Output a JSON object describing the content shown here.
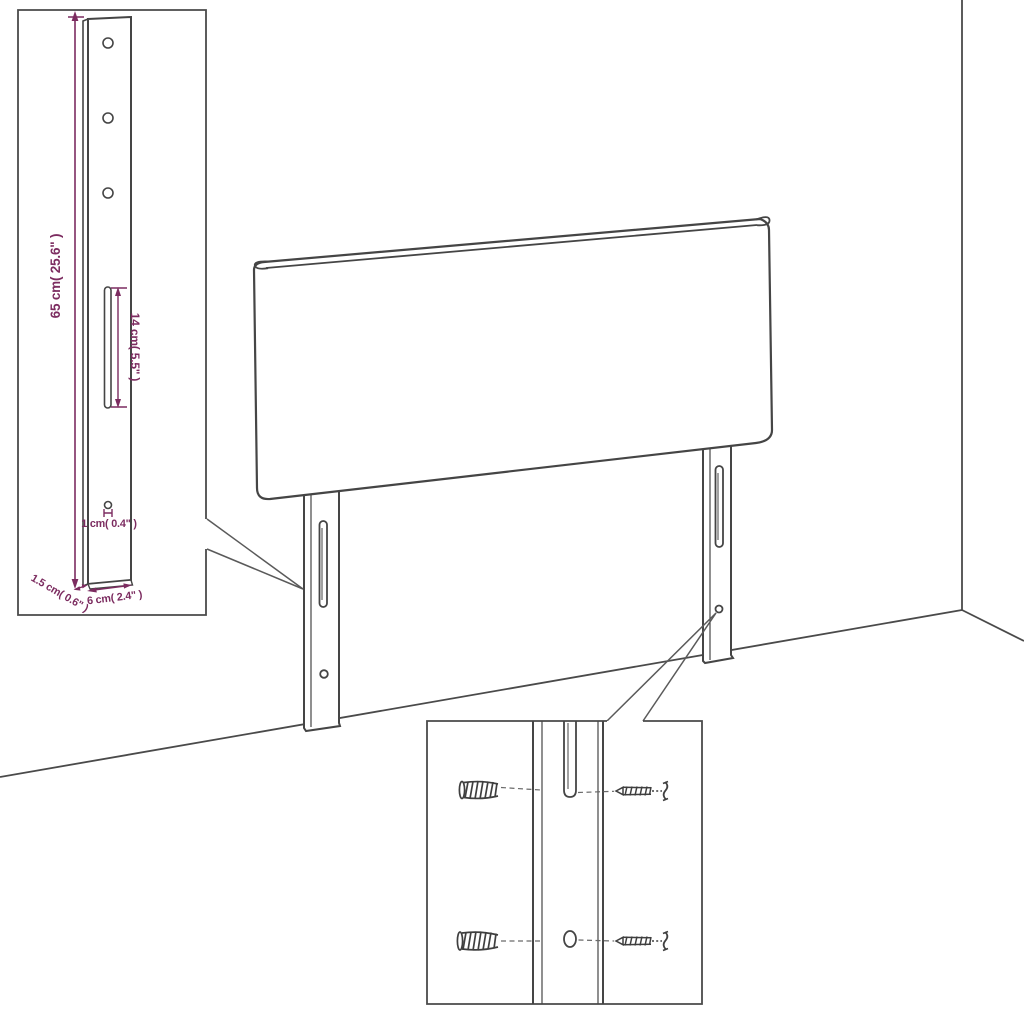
{
  "diagram": {
    "type": "product-dimension-drawing",
    "subject": "upholstered headboard with two adjustable mounting legs",
    "views": {
      "main": "perspective view of headboard standing against wall corner",
      "inset_top_left": "magnified front view of mounting leg with drill holes and slot",
      "inset_bottom": "magnified mounting detail with wall plugs and screws aligned to leg slot and hole"
    }
  },
  "dims": {
    "height": "65 cm( 25.6\" )",
    "slot": "14 cm( 5.5\" )",
    "hole": "1 cm( 0.4\" )",
    "depth": "1.5 cm( 0.6\" )",
    "width": "6 cm( 2.4\" )"
  },
  "colors": {
    "line_art": "#474747",
    "dimension_accent": "#7C2C60",
    "background": "#ffffff"
  }
}
